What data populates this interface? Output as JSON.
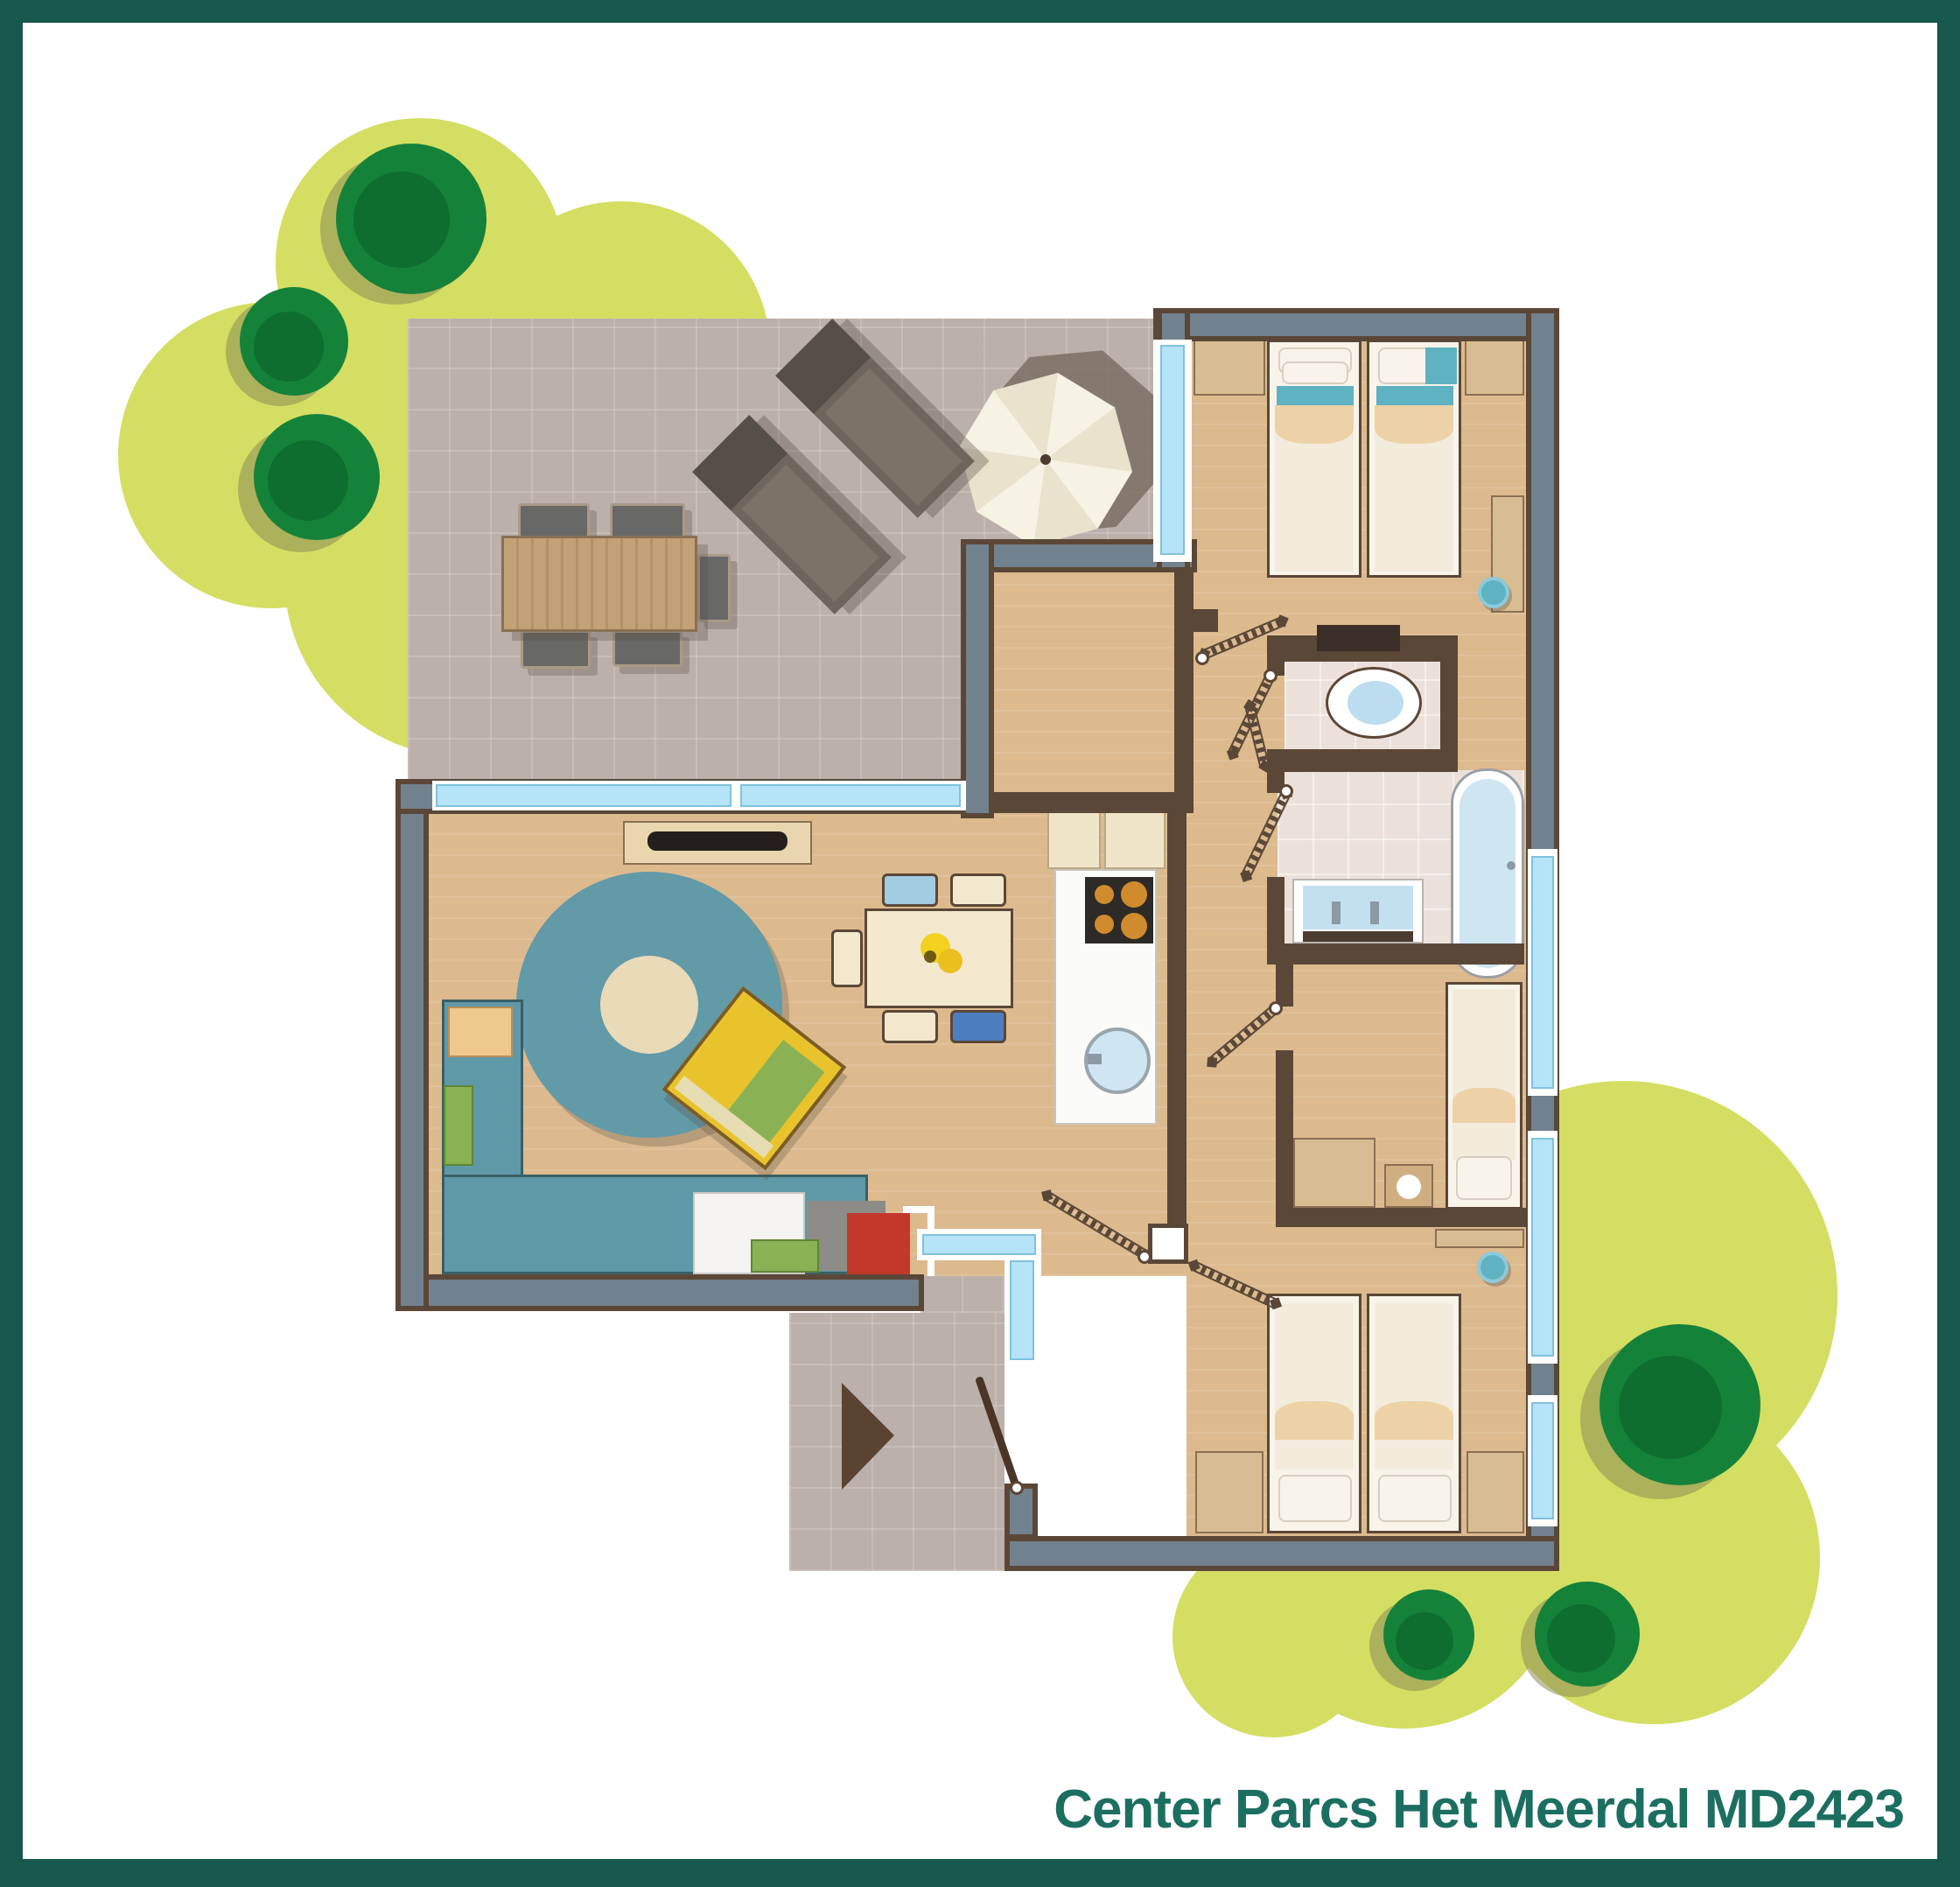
{
  "title": {
    "text": "Center Parcs Het Meerdal MD2423"
  },
  "palette": {
    "frame": "#17594d",
    "title": "#1c6f60",
    "garden": "#d4de62",
    "bush": "#15823a",
    "bush_dark": "#0c6b2e",
    "bush_shadow": "#8a8c55",
    "terrace": "#bcb0ab",
    "floor_tan": "#dcba8e",
    "tile": "#ebe1da",
    "wall": "#5b4737",
    "wall_slate": "#72818e",
    "glass": "#b5e3f7",
    "glass_edge": "#7fc2dd",
    "bed_frame": "#f8f4ea",
    "mattress": "#f3ecdc",
    "fold": "#ecd2a6",
    "accent_teal": "#5fb2c2",
    "sofa": "#5f99a8",
    "rug": "#629aa8",
    "rug_center": "#e9dab8",
    "cushion_green": "#8ab254",
    "armchair_yellow": "#e9c32b",
    "chair_blue_light": "#a3cbe2",
    "chair_blue_dark": "#4d7fc0",
    "cream": "#f3e8ce",
    "counter_white": "#fbfbf9",
    "stove": "#2e2a28",
    "burner": "#cf8b2d",
    "fire_red": "#c2392c",
    "fire_gray": "#8e8c88",
    "wood": "#c2a176",
    "lounger": "#6f655c",
    "lounger_head": "#564f48",
    "parasol": "#f4f0e1",
    "parasol_shadow": "#7b6e63",
    "water": "#cfe6f2",
    "arrow": "#5b4332"
  }
}
